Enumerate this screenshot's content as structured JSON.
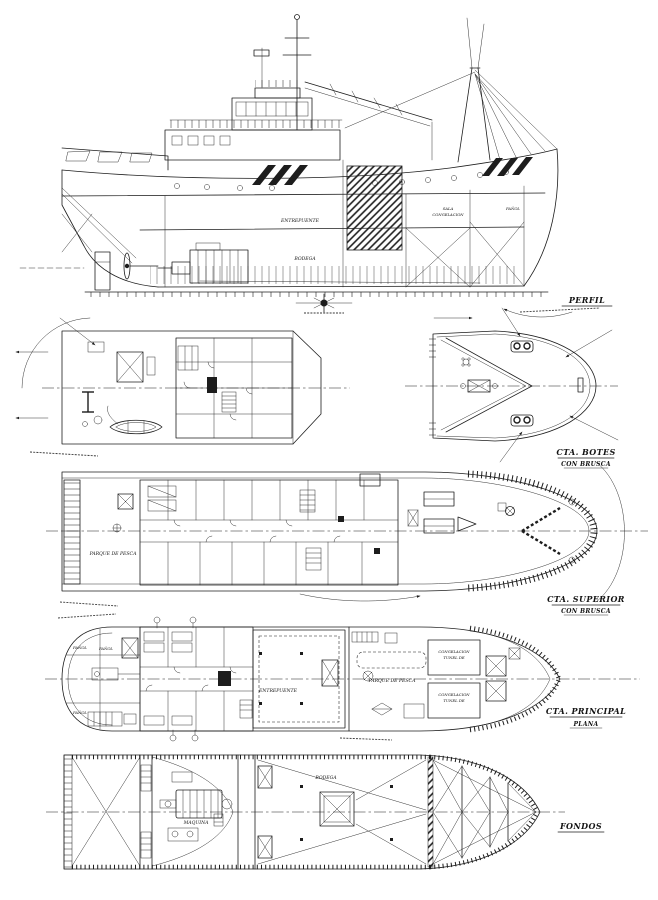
{
  "colors": {
    "ink": "#1d1d1d",
    "paper": "#ffffff"
  },
  "views": {
    "perfil": {
      "label": "PERFIL"
    },
    "botes": {
      "label": "CTA.  BOTES",
      "sublabel": "CON  BRUSCA"
    },
    "superior": {
      "label": "CTA.  SUPERIOR",
      "sublabel": "CON  BRUSCA"
    },
    "principal": {
      "label": "CTA.  PRINCIPAL",
      "sublabel": "PLANA"
    },
    "fondos": {
      "label": "FONDOS"
    }
  },
  "perfil": {
    "entrepuente": "ENTREPUENTE",
    "bodega": "BODEGA",
    "sala": "SALA",
    "congelacion": "CONGELACION",
    "panol": "PAÑOL"
  },
  "superior": {
    "parque": "PARQUE DE PESCA"
  },
  "principal": {
    "entrepuente": "ENTREPUENTE",
    "parque": "PARQUE DE PESCA",
    "tunel1a": "CONGELACION",
    "tunel1b": "TUNEL DE",
    "tunel2a": "CONGELACION",
    "tunel2b": "TUNEL DE",
    "panol1": "PAÑOL",
    "panol2": "PAÑOL",
    "panol3": "PAÑOL"
  },
  "fondos": {
    "maquina": "MAQUINA",
    "bodega": "BODEGA"
  }
}
